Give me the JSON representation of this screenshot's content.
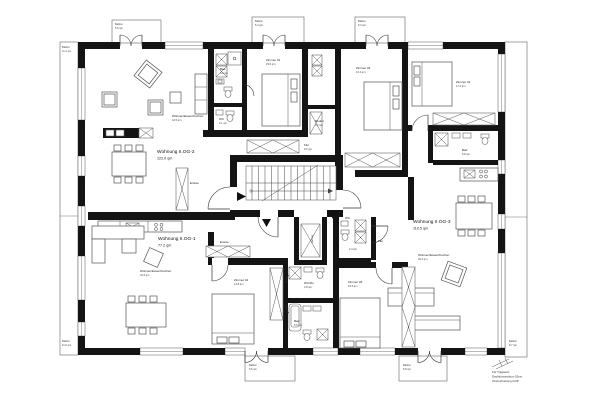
{
  "floorplan": {
    "apartments": {
      "og2": {
        "name": "Wohnung II.OG-2",
        "area": "122.0 qm"
      },
      "og1": {
        "name": "Wohnung II.OG-1",
        "area": "77.2 qm"
      },
      "og3": {
        "name": "Wohnung II.OG-3",
        "area": "110.5 qm"
      }
    },
    "rooms": {
      "og2_living": {
        "name": "Wohnen/Essen/Kochen",
        "area": "42.5 qm"
      },
      "og2_zimmer1": {
        "name": "Zimmer 01",
        "area": "15.6 qm"
      },
      "og2_zimmer2": {
        "name": "Zimmer 02",
        "area": "16.4 qm"
      },
      "og2_bad": {
        "name": "Bad",
        "area": "6.2 qm"
      },
      "og2_wc": {
        "name": "WC",
        "area": "2.1 qm"
      },
      "og2_reduit": {
        "name": "Reduit",
        "area": "3.2 qm"
      },
      "og2_flur": {
        "name": "Flur",
        "area": "9.6 qm"
      },
      "og2_entree": {
        "name": "Entrée"
      },
      "og1_living": {
        "name": "Wohnen/Essen/Kochen",
        "area": "32.6 qm"
      },
      "og1_entree": {
        "name": "Entrée"
      },
      "og1_zimmer1": {
        "name": "Zimmer 01",
        "area": "14.8 qm"
      },
      "og1_wcdu": {
        "name": "WC/Du",
        "area": "3.8 qm"
      },
      "og1_bad": {
        "name": "Bad",
        "area": "5.6 qm"
      },
      "og3_flur": {
        "name": "Flur"
      },
      "og3_wc": {
        "name": "WC",
        "area": "2.4 qm"
      },
      "og3_zimmer1": {
        "name": "Zimmer 01",
        "area": "17.2 qm"
      },
      "og3_zimmer2": {
        "name": "Zimmer 02",
        "area": "15.4 qm"
      },
      "og3_bad": {
        "name": "Bad",
        "area": "5.8 qm"
      },
      "og3_living": {
        "name": "Wohnen/Essen/Kochen",
        "area": "40.2 qm"
      },
      "lift": {
        "name": "Aufzug"
      }
    },
    "balconies": {
      "top1": {
        "name": "Balkon",
        "area": "5.6 qm"
      },
      "top2": {
        "name": "Balkon",
        "area": "5.4 qm"
      },
      "top3": {
        "name": "Balkon",
        "area": "5.4 qm"
      },
      "left_upper": {
        "name": "Balkon",
        "area": "11.2 qm"
      },
      "left_lower": {
        "name": "Balkon",
        "area": "11.0 qm"
      },
      "bottom1": {
        "name": "Balkon",
        "area": "5.6 qm"
      },
      "bottom2": {
        "name": "Balkon",
        "area": "5.8 qm"
      },
      "right": {
        "name": "Balkon",
        "area": "9.7 qm"
      }
    },
    "notes": {
      "line1": "Für Tragwerk:",
      "line2": "Dachkonstruktion 55cm",
      "line3": "Überschreitung GOP"
    },
    "colors": {
      "wall": "#141414",
      "line": "#3a3a3a",
      "text": "#1c1c1c",
      "background": "#ffffff"
    }
  }
}
